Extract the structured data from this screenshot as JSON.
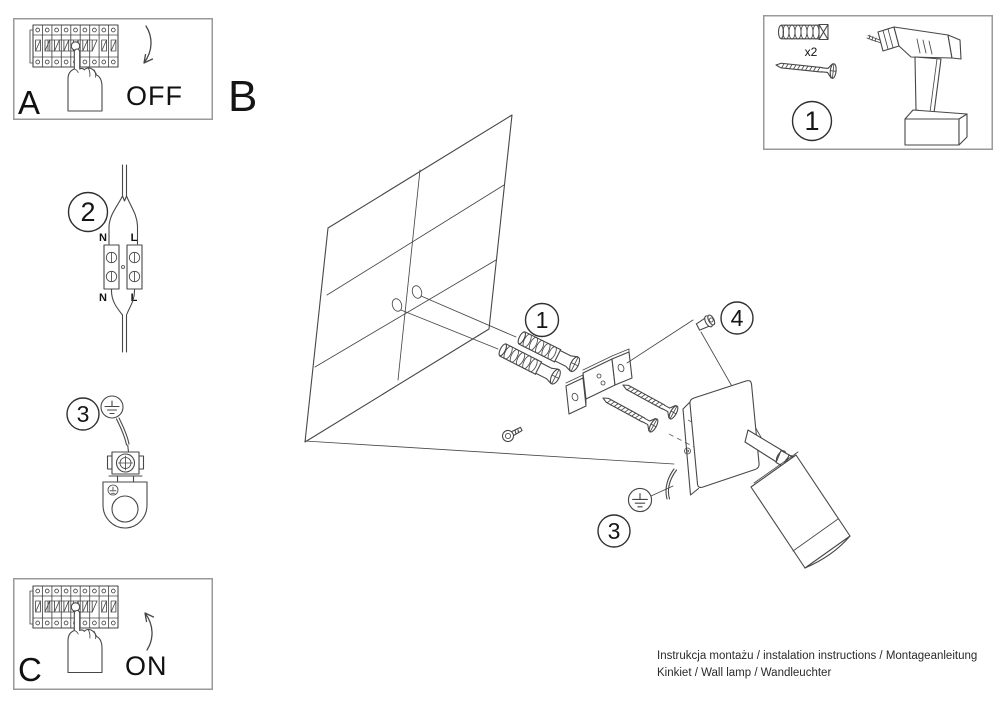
{
  "page": {
    "background": "#ffffff"
  },
  "colors": {
    "line": "#474747",
    "panel_border": "#9a9a9a",
    "text": "#111111",
    "dash": "#6b6b6b"
  },
  "panel_a": {
    "label": "A",
    "state": "OFF"
  },
  "panel_c": {
    "label": "C",
    "state": "ON"
  },
  "main_label": "B",
  "callouts": {
    "tools": "1",
    "anchors": "1",
    "wire_connector": "2",
    "earth_left": "3",
    "earth_lamp": "3",
    "set_screw": "4"
  },
  "wiring": {
    "top_n": "N",
    "top_l": "L",
    "bottom_n": "N",
    "bottom_l": "L"
  },
  "tools_panel": {
    "anchor_qty": "x2"
  },
  "footer": {
    "line1": "Instrukcja montażu / instalation instructions / Montageanleitung",
    "line2": "Kinkiet / Wall lamp / Wandleuchter"
  }
}
